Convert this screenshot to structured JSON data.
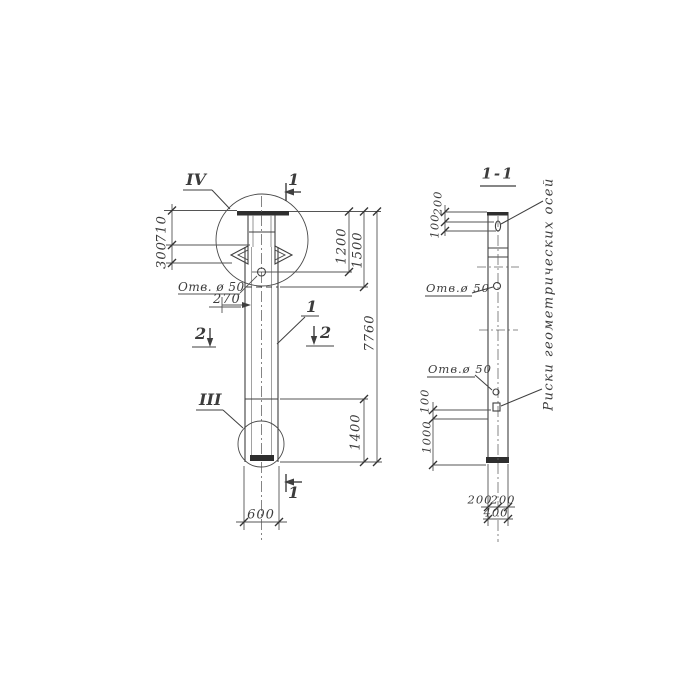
{
  "main_view": {
    "detail_top_label": "IV",
    "detail_bottom_label": "III",
    "section_top_label": "1",
    "section_bottom_label": "1",
    "section_left_label": "2",
    "section_right_label": "2",
    "part_leader_label": "1",
    "dim_710": "710",
    "dim_300": "300",
    "hole_label": "Отв. ø 50",
    "dim_270": "270",
    "dim_1200": "1200",
    "dim_1500": "1500",
    "dim_7760": "7760",
    "dim_1400": "1400",
    "dim_600": "600"
  },
  "section_view": {
    "title": "1-1",
    "dim_200_top": "200",
    "dim_100_top": "100",
    "hole_label_upper": "Отв.ø 50",
    "hole_label_lower": "Отв.ø 50",
    "dim_100_left": "100",
    "dim_1000_left": "1000",
    "dim_200_bottom_left": "200",
    "dim_200_bottom_right": "200",
    "dim_400_bottom": "400",
    "axes_note": "Риски геометрических осей"
  }
}
